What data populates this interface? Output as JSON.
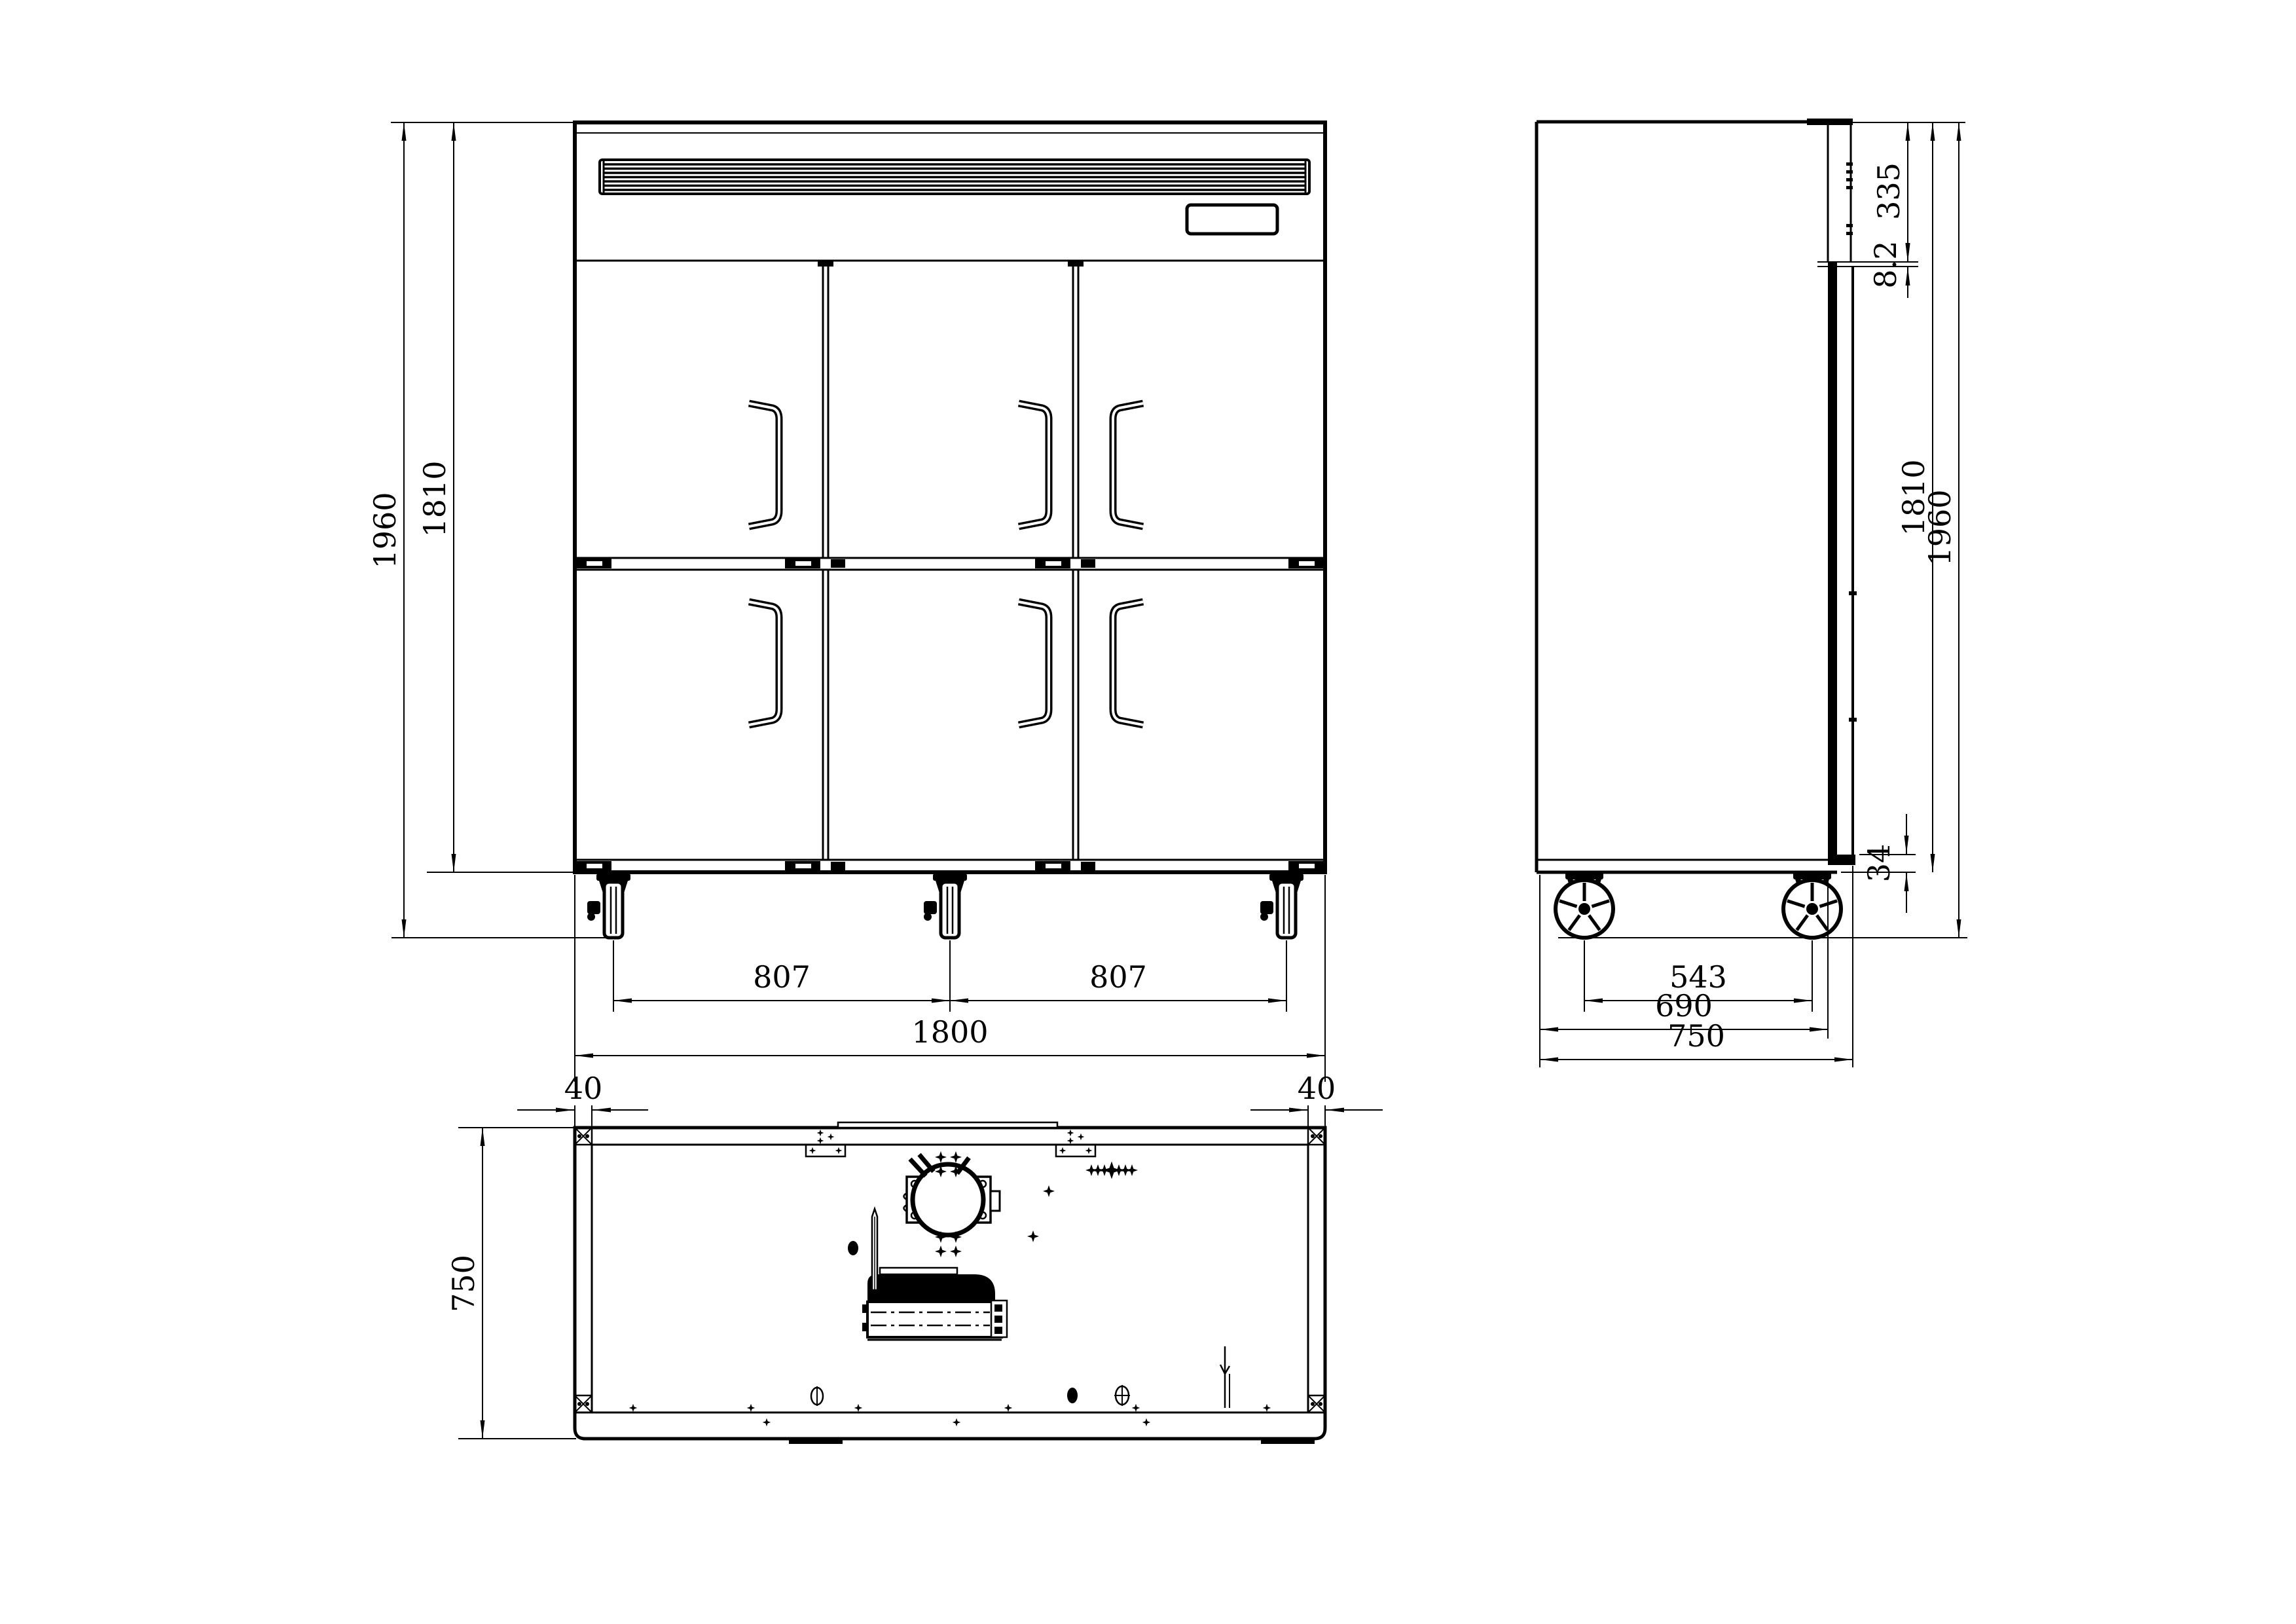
{
  "drawing": {
    "colors": {
      "line": "#000000",
      "background": "#ffffff"
    },
    "front": {
      "overall_height": "1960",
      "body_height": "1810",
      "caster_pitch_left": "807",
      "caster_pitch_right": "807",
      "overall_width": "1800"
    },
    "side": {
      "top_section": "335",
      "recess": "8.2",
      "body_height": "1810",
      "overall_height": "1960",
      "bottom_gap": "34",
      "caster_pitch": "543",
      "body_depth": "690",
      "overall_depth": "750"
    },
    "bottom": {
      "offset_left": "40",
      "offset_right": "40",
      "depth": "750"
    }
  }
}
